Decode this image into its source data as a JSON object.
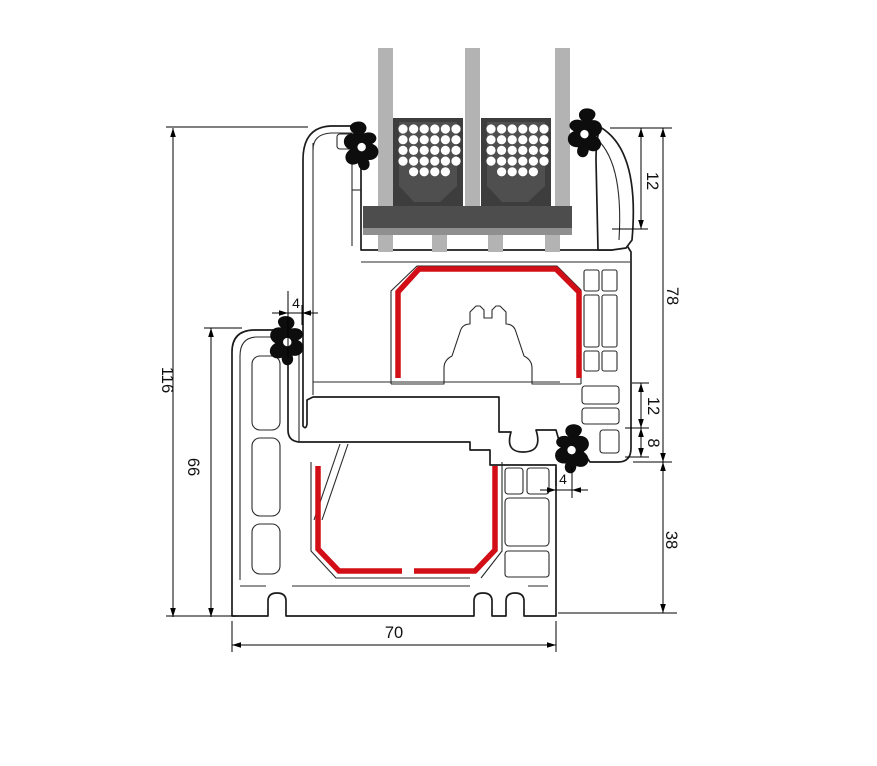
{
  "diagram": {
    "type": "window-profile-cross-section",
    "dims": {
      "left_outer": "116",
      "left_inner": "66",
      "top_small_left": "4",
      "right_top": "12",
      "right_outer": "78",
      "right_mid_upper": "12",
      "right_mid_lower": "8",
      "right_small": "4",
      "right_lower": "38",
      "bottom": "70"
    },
    "colors": {
      "outline": "#1c1c1c",
      "steel_reinforcement": "#d20f16",
      "glass": "#b3b3b3",
      "glazing_block_outer": "#3d3d3d",
      "glazing_block_inner": "#4f4f4f",
      "glazing_bridge": "#4d4d4d",
      "bridge_strip": "#8f8f8f",
      "gasket": "#0d0d0d",
      "background": "#ffffff"
    }
  }
}
